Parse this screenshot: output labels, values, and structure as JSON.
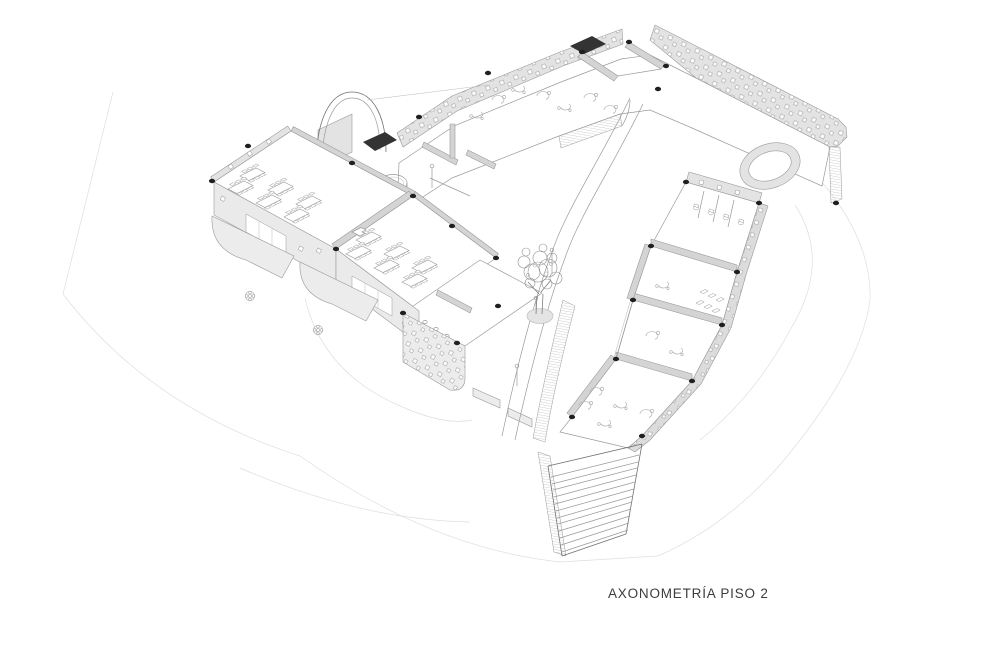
{
  "page": {
    "background": "#ffffff",
    "width": 1000,
    "height": 647
  },
  "caption": {
    "text": "AXONOMETRÍA PISO 2"
  },
  "colors": {
    "paper": "#ffffff",
    "line": "#9a9a9a",
    "line-light": "#c4c4c4",
    "line-faint": "#dedede",
    "line-dark": "#707070",
    "wall": "#e3e3e3",
    "wall-dark": "#d4d4d4",
    "slab": "#ececec",
    "canopy": "#333333",
    "dot": "#1f1f1f",
    "text": "#3c3c3c",
    "tree": "#8f8f8f"
  },
  "drawing": {
    "type": "axonometric-architectural-drawing",
    "elements": [
      "north-wing",
      "left-classroom-wing",
      "east-wing",
      "toilet-block",
      "central-courtyard",
      "courtyard-tree",
      "cylindrical-planter",
      "arched-slide",
      "curved-ramp",
      "exterior-staircase",
      "balconies",
      "column-markers",
      "site-boundary"
    ]
  }
}
